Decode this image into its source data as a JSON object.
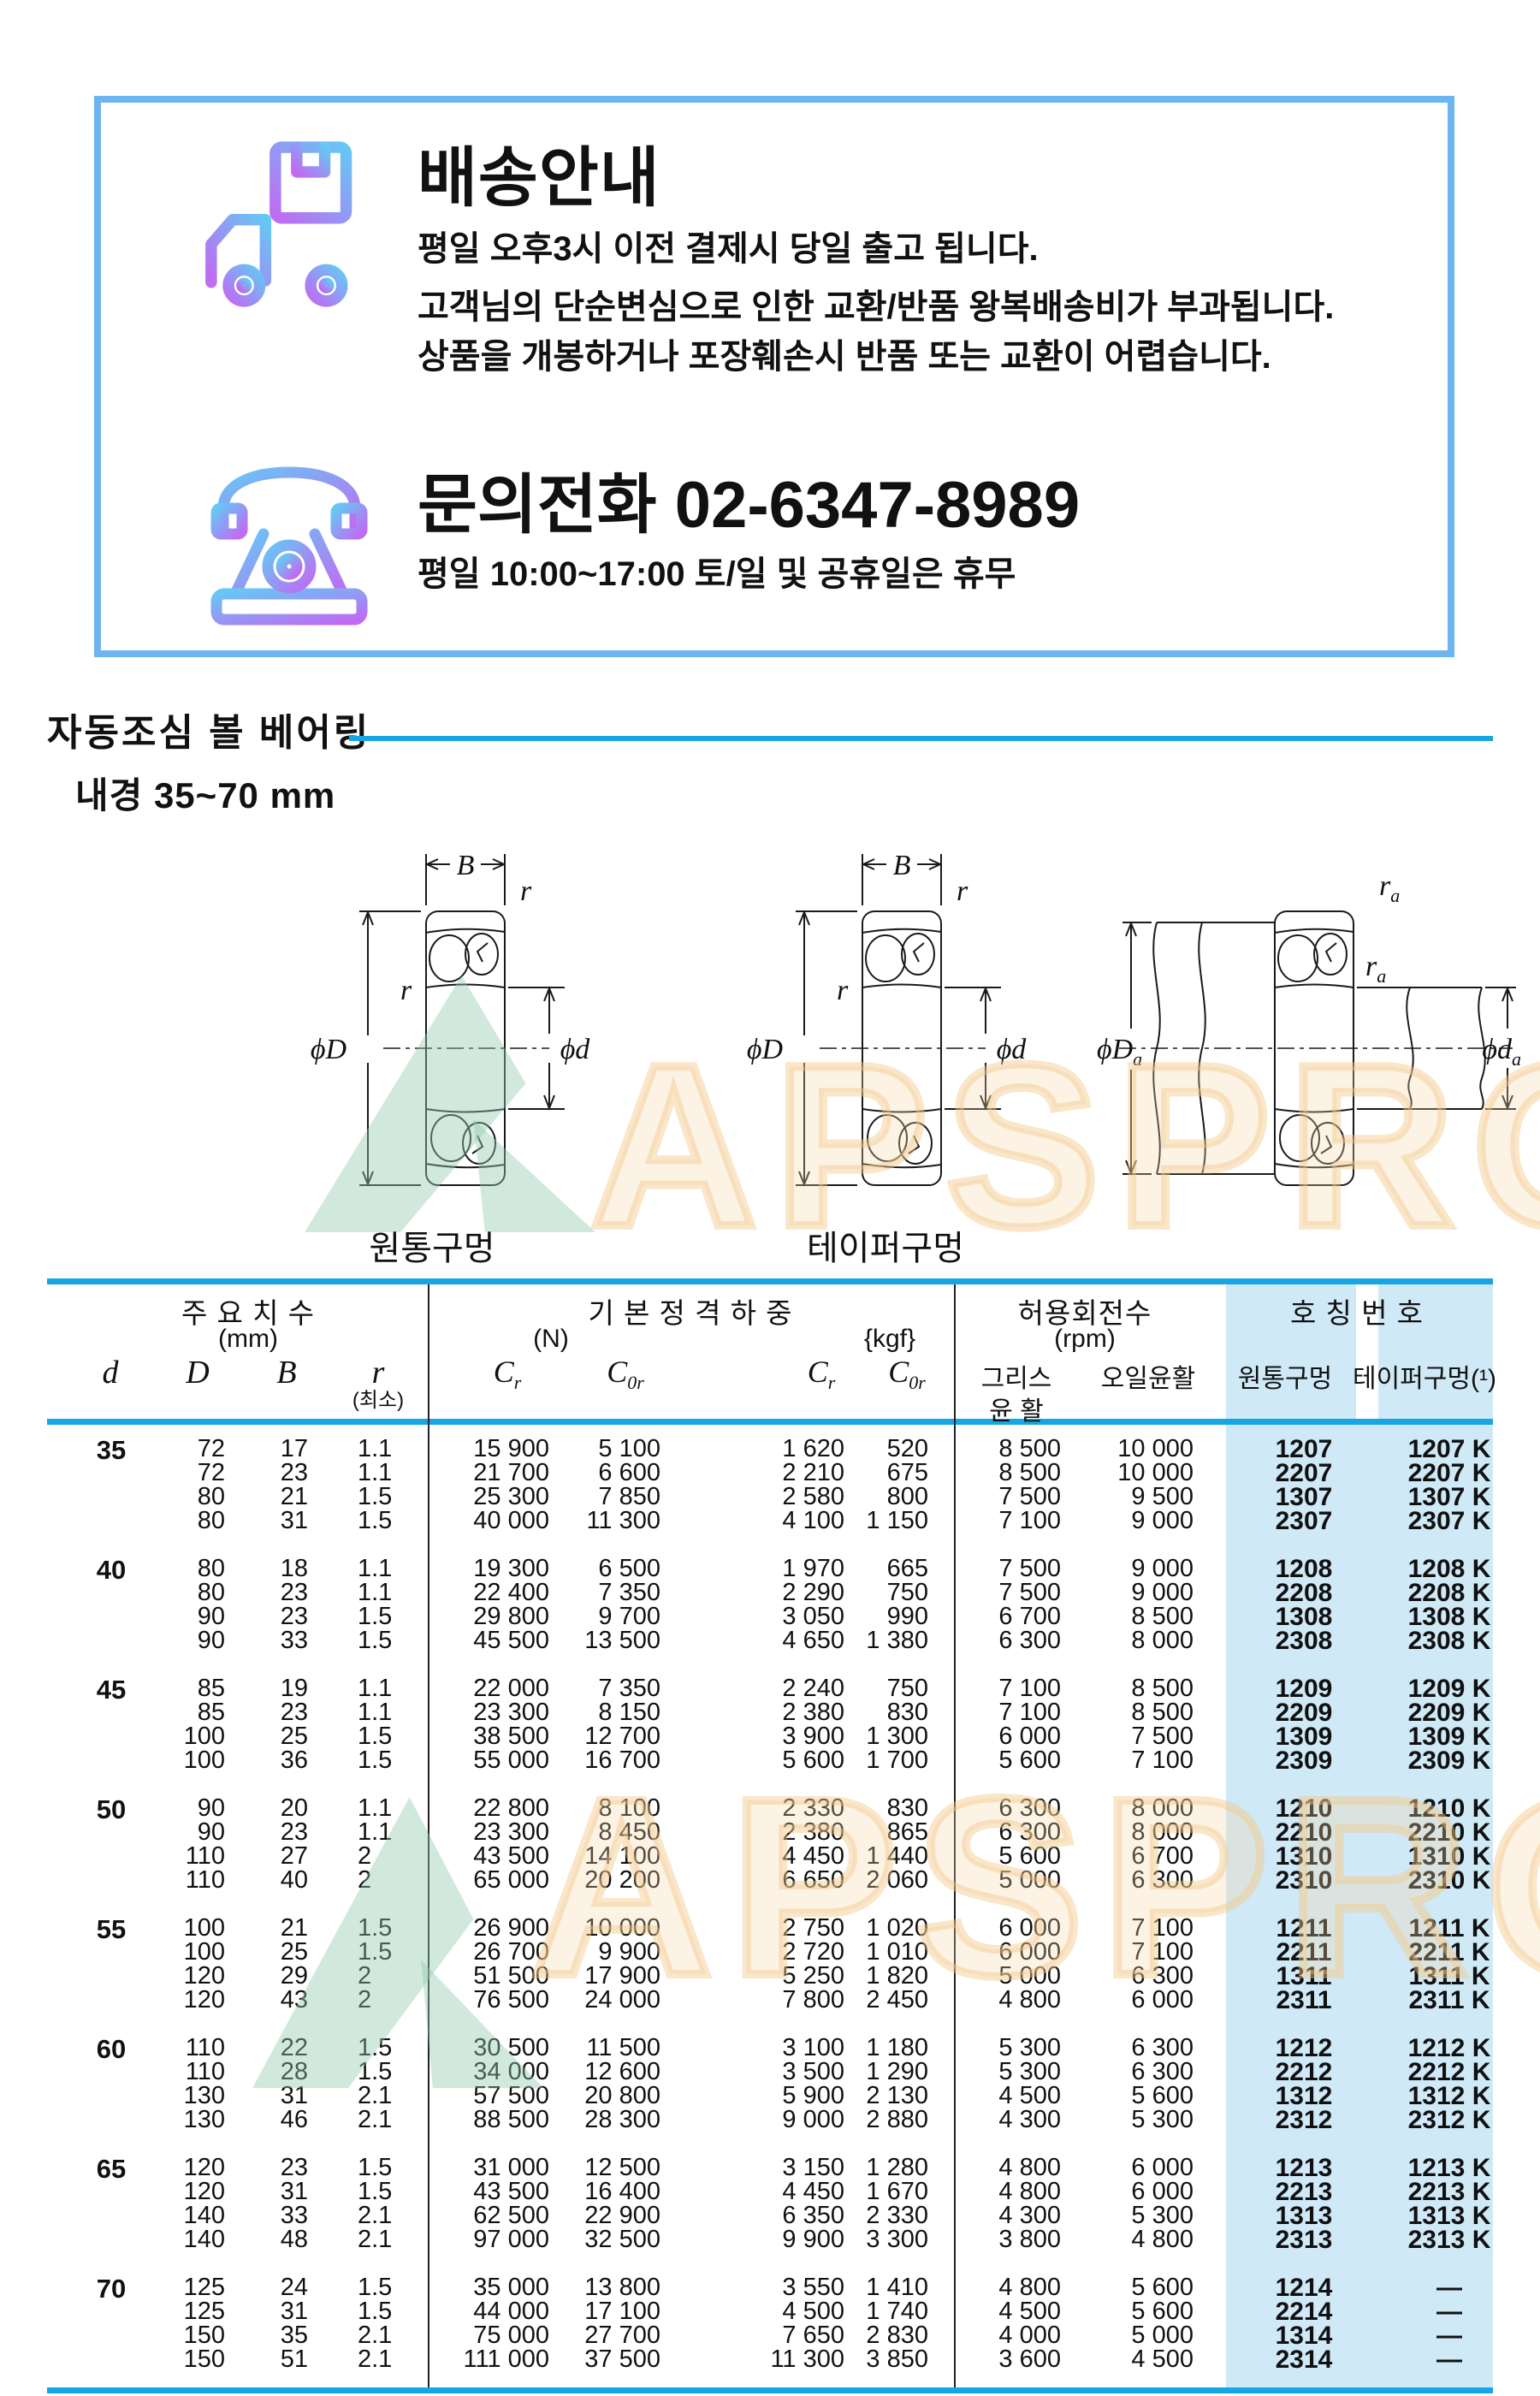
{
  "shipping": {
    "title": "배송안내",
    "lines": [
      "평일 오후3시 이전 결제시 당일 출고 됩니다.",
      "고객님의 단순변심으로 인한 교환/반품 왕복배송비가 부과됩니다.",
      "상품을 개봉하거나 포장훼손시 반품 또는 교환이 어렵습니다."
    ],
    "phone_title": "문의전화  02-6347-8989",
    "phone_hours": "평일 10:00~17:00 토/일 및 공휴일은 휴무"
  },
  "section": {
    "title": "자동조심 볼 베어링",
    "subtitle": "내경 35~70 mm"
  },
  "diagrams": {
    "cyl_label": "원통구멍",
    "taper_label": "테이퍼구멍",
    "dim_B": "B",
    "dim_r": "r",
    "dim_phiD": "ϕD",
    "dim_phid": "ϕd",
    "sub_a": "a"
  },
  "watermark": {
    "text": "APSPRO"
  },
  "colors": {
    "accent_cyan": "#16a6e4",
    "box_border": "#6cb5f0",
    "highlight_bg": "#cfe9f7",
    "icon_gradient_from": "#c06bf2",
    "icon_gradient_to": "#66c7f5"
  },
  "table": {
    "h": {
      "size": "주 요 치 수",
      "size_u": "(mm)",
      "load": "기 본 정 격 하 중",
      "load_n": "(N)",
      "load_kgf": "{kgf}",
      "speed": "허용회전수",
      "speed_u": "(rpm)",
      "number": "호 칭 번 호",
      "d": "d",
      "D": "D",
      "B": "B",
      "r": "r",
      "r_min": "(최소)",
      "c": "C",
      "c_r": "r",
      "c_0r": "0r",
      "grease1": "그리스",
      "grease2": "윤 활",
      "oil": "오일윤활",
      "cyl": "원통구멍",
      "taper": "테이퍼구멍(¹)"
    },
    "groups": [
      {
        "d": "35",
        "rows": [
          [
            "72",
            "17",
            "1.1",
            "15 900",
            "5 100",
            "1 620",
            "520",
            "8 500",
            "10 000",
            "1207",
            "1207 K"
          ],
          [
            "72",
            "23",
            "1.1",
            "21 700",
            "6 600",
            "2 210",
            "675",
            "8 500",
            "10 000",
            "2207",
            "2207 K"
          ],
          [
            "80",
            "21",
            "1.5",
            "25 300",
            "7 850",
            "2 580",
            "800",
            "7 500",
            "9 500",
            "1307",
            "1307 K"
          ],
          [
            "80",
            "31",
            "1.5",
            "40 000",
            "11 300",
            "4 100",
            "1 150",
            "7 100",
            "9 000",
            "2307",
            "2307 K"
          ]
        ]
      },
      {
        "d": "40",
        "rows": [
          [
            "80",
            "18",
            "1.1",
            "19 300",
            "6 500",
            "1 970",
            "665",
            "7 500",
            "9 000",
            "1208",
            "1208 K"
          ],
          [
            "80",
            "23",
            "1.1",
            "22 400",
            "7 350",
            "2 290",
            "750",
            "7 500",
            "9 000",
            "2208",
            "2208 K"
          ],
          [
            "90",
            "23",
            "1.5",
            "29 800",
            "9 700",
            "3 050",
            "990",
            "6 700",
            "8 500",
            "1308",
            "1308 K"
          ],
          [
            "90",
            "33",
            "1.5",
            "45 500",
            "13 500",
            "4 650",
            "1 380",
            "6 300",
            "8 000",
            "2308",
            "2308 K"
          ]
        ]
      },
      {
        "d": "45",
        "rows": [
          [
            "85",
            "19",
            "1.1",
            "22 000",
            "7 350",
            "2 240",
            "750",
            "7 100",
            "8 500",
            "1209",
            "1209 K"
          ],
          [
            "85",
            "23",
            "1.1",
            "23 300",
            "8 150",
            "2 380",
            "830",
            "7 100",
            "8 500",
            "2209",
            "2209 K"
          ],
          [
            "100",
            "25",
            "1.5",
            "38 500",
            "12 700",
            "3 900",
            "1 300",
            "6 000",
            "7 500",
            "1309",
            "1309 K"
          ],
          [
            "100",
            "36",
            "1.5",
            "55 000",
            "16 700",
            "5 600",
            "1 700",
            "5 600",
            "7 100",
            "2309",
            "2309 K"
          ]
        ]
      },
      {
        "d": "50",
        "rows": [
          [
            "90",
            "20",
            "1.1",
            "22 800",
            "8 100",
            "2 330",
            "830",
            "6 300",
            "8 000",
            "1210",
            "1210 K"
          ],
          [
            "90",
            "23",
            "1.1",
            "23 300",
            "8 450",
            "2 380",
            "865",
            "6 300",
            "8 000",
            "2210",
            "2210 K"
          ],
          [
            "110",
            "27",
            "2",
            "43 500",
            "14 100",
            "4 450",
            "1 440",
            "5 600",
            "6 700",
            "1310",
            "1310 K"
          ],
          [
            "110",
            "40",
            "2",
            "65 000",
            "20 200",
            "6 650",
            "2 060",
            "5 000",
            "6 300",
            "2310",
            "2310 K"
          ]
        ]
      },
      {
        "d": "55",
        "rows": [
          [
            "100",
            "21",
            "1.5",
            "26 900",
            "10 000",
            "2 750",
            "1 020",
            "6 000",
            "7 100",
            "1211",
            "1211 K"
          ],
          [
            "100",
            "25",
            "1.5",
            "26 700",
            "9 900",
            "2 720",
            "1 010",
            "6 000",
            "7 100",
            "2211",
            "2211 K"
          ],
          [
            "120",
            "29",
            "2",
            "51 500",
            "17 900",
            "5 250",
            "1 820",
            "5 000",
            "6 300",
            "1311",
            "1311 K"
          ],
          [
            "120",
            "43",
            "2",
            "76 500",
            "24 000",
            "7 800",
            "2 450",
            "4 800",
            "6 000",
            "2311",
            "2311 K"
          ]
        ]
      },
      {
        "d": "60",
        "rows": [
          [
            "110",
            "22",
            "1.5",
            "30 500",
            "11 500",
            "3 100",
            "1 180",
            "5 300",
            "6 300",
            "1212",
            "1212 K"
          ],
          [
            "110",
            "28",
            "1.5",
            "34 000",
            "12 600",
            "3 500",
            "1 290",
            "5 300",
            "6 300",
            "2212",
            "2212 K"
          ],
          [
            "130",
            "31",
            "2.1",
            "57 500",
            "20 800",
            "5 900",
            "2 130",
            "4 500",
            "5 600",
            "1312",
            "1312 K"
          ],
          [
            "130",
            "46",
            "2.1",
            "88 500",
            "28 300",
            "9 000",
            "2 880",
            "4 300",
            "5 300",
            "2312",
            "2312 K"
          ]
        ]
      },
      {
        "d": "65",
        "rows": [
          [
            "120",
            "23",
            "1.5",
            "31 000",
            "12 500",
            "3 150",
            "1 280",
            "4 800",
            "6 000",
            "1213",
            "1213 K"
          ],
          [
            "120",
            "31",
            "1.5",
            "43 500",
            "16 400",
            "4 450",
            "1 670",
            "4 800",
            "6 000",
            "2213",
            "2213 K"
          ],
          [
            "140",
            "33",
            "2.1",
            "62 500",
            "22 900",
            "6 350",
            "2 330",
            "4 300",
            "5 300",
            "1313",
            "1313 K"
          ],
          [
            "140",
            "48",
            "2.1",
            "97 000",
            "32 500",
            "9 900",
            "3 300",
            "3 800",
            "4 800",
            "2313",
            "2313 K"
          ]
        ]
      },
      {
        "d": "70",
        "rows": [
          [
            "125",
            "24",
            "1.5",
            "35 000",
            "13 800",
            "3 550",
            "1 410",
            "4 800",
            "5 600",
            "1214",
            "—"
          ],
          [
            "125",
            "31",
            "1.5",
            "44 000",
            "17 100",
            "4 500",
            "1 740",
            "4 500",
            "5 600",
            "2214",
            "—"
          ],
          [
            "150",
            "35",
            "2.1",
            "75 000",
            "27 700",
            "7 650",
            "2 830",
            "4 000",
            "5 000",
            "1314",
            "—"
          ],
          [
            "150",
            "51",
            "2.1",
            "111 000",
            "37 500",
            "11 300",
            "3 850",
            "3 600",
            "4 500",
            "2314",
            "—"
          ]
        ]
      }
    ]
  }
}
